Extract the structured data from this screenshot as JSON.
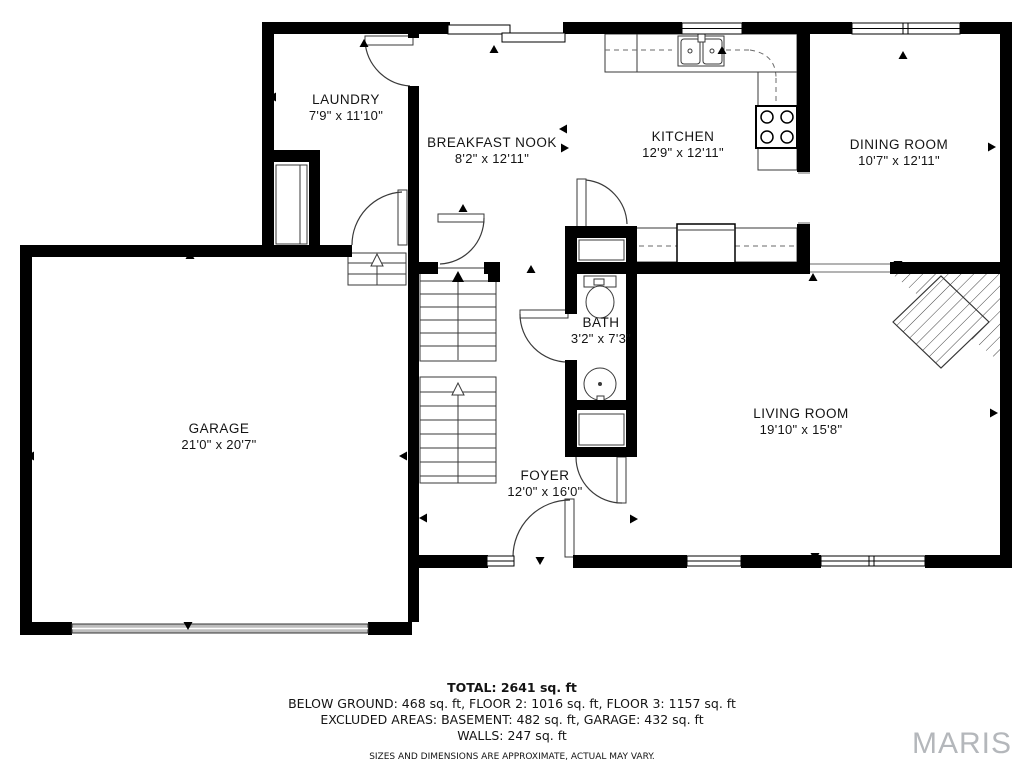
{
  "floorplan": {
    "rooms": {
      "laundry": {
        "name": "LAUNDRY",
        "dims": "7'9\" x 11'10\""
      },
      "breakfast_nook": {
        "name": "BREAKFAST NOOK",
        "dims": "8'2\" x 12'11\""
      },
      "kitchen": {
        "name": "KITCHEN",
        "dims": "12'9\" x 12'11\""
      },
      "dining_room": {
        "name": "DINING ROOM",
        "dims": "10'7\" x 12'11\""
      },
      "garage": {
        "name": "GARAGE",
        "dims": "21'0\" x 20'7\""
      },
      "bath": {
        "name": "BATH",
        "dims": "3'2\" x 7'3\""
      },
      "foyer": {
        "name": "FOYER",
        "dims": "12'0\" x 16'0\""
      },
      "living_room": {
        "name": "LIVING ROOM",
        "dims": "19'10\" x 15'8\""
      }
    },
    "markers": [
      {
        "x": 364,
        "y": 43,
        "dir": "up"
      },
      {
        "x": 494,
        "y": 49,
        "dir": "up"
      },
      {
        "x": 722,
        "y": 50,
        "dir": "up"
      },
      {
        "x": 903,
        "y": 55,
        "dir": "up"
      },
      {
        "x": 272,
        "y": 97,
        "dir": "left"
      },
      {
        "x": 563,
        "y": 129,
        "dir": "left"
      },
      {
        "x": 565,
        "y": 148,
        "dir": "right"
      },
      {
        "x": 463,
        "y": 208,
        "dir": "up"
      },
      {
        "x": 531,
        "y": 269,
        "dir": "up"
      },
      {
        "x": 813,
        "y": 277,
        "dir": "up"
      },
      {
        "x": 898,
        "y": 265,
        "dir": "down"
      },
      {
        "x": 992,
        "y": 147,
        "dir": "right"
      },
      {
        "x": 994,
        "y": 413,
        "dir": "right"
      },
      {
        "x": 30,
        "y": 456,
        "dir": "left"
      },
      {
        "x": 403,
        "y": 456,
        "dir": "left"
      },
      {
        "x": 190,
        "y": 255,
        "dir": "up"
      },
      {
        "x": 188,
        "y": 626,
        "dir": "down"
      },
      {
        "x": 423,
        "y": 518,
        "dir": "left"
      },
      {
        "x": 540,
        "y": 561,
        "dir": "down"
      },
      {
        "x": 634,
        "y": 519,
        "dir": "right"
      },
      {
        "x": 815,
        "y": 557,
        "dir": "down"
      }
    ]
  },
  "footer": {
    "total": "TOTAL: 2641 sq. ft",
    "floors": "BELOW GROUND: 468 sq. ft, FLOOR 2: 1016 sq. ft, FLOOR 3: 1157 sq. ft",
    "excluded": "EXCLUDED AREAS: BASEMENT: 482 sq. ft, GARAGE: 432 sq. ft",
    "walls": "WALLS: 247 sq. ft",
    "disclaimer": "SIZES AND DIMENSIONS ARE APPROXIMATE, ACTUAL MAY VARY."
  },
  "watermark": {
    "text": "MARIS",
    "color": "#b4b7bb"
  }
}
